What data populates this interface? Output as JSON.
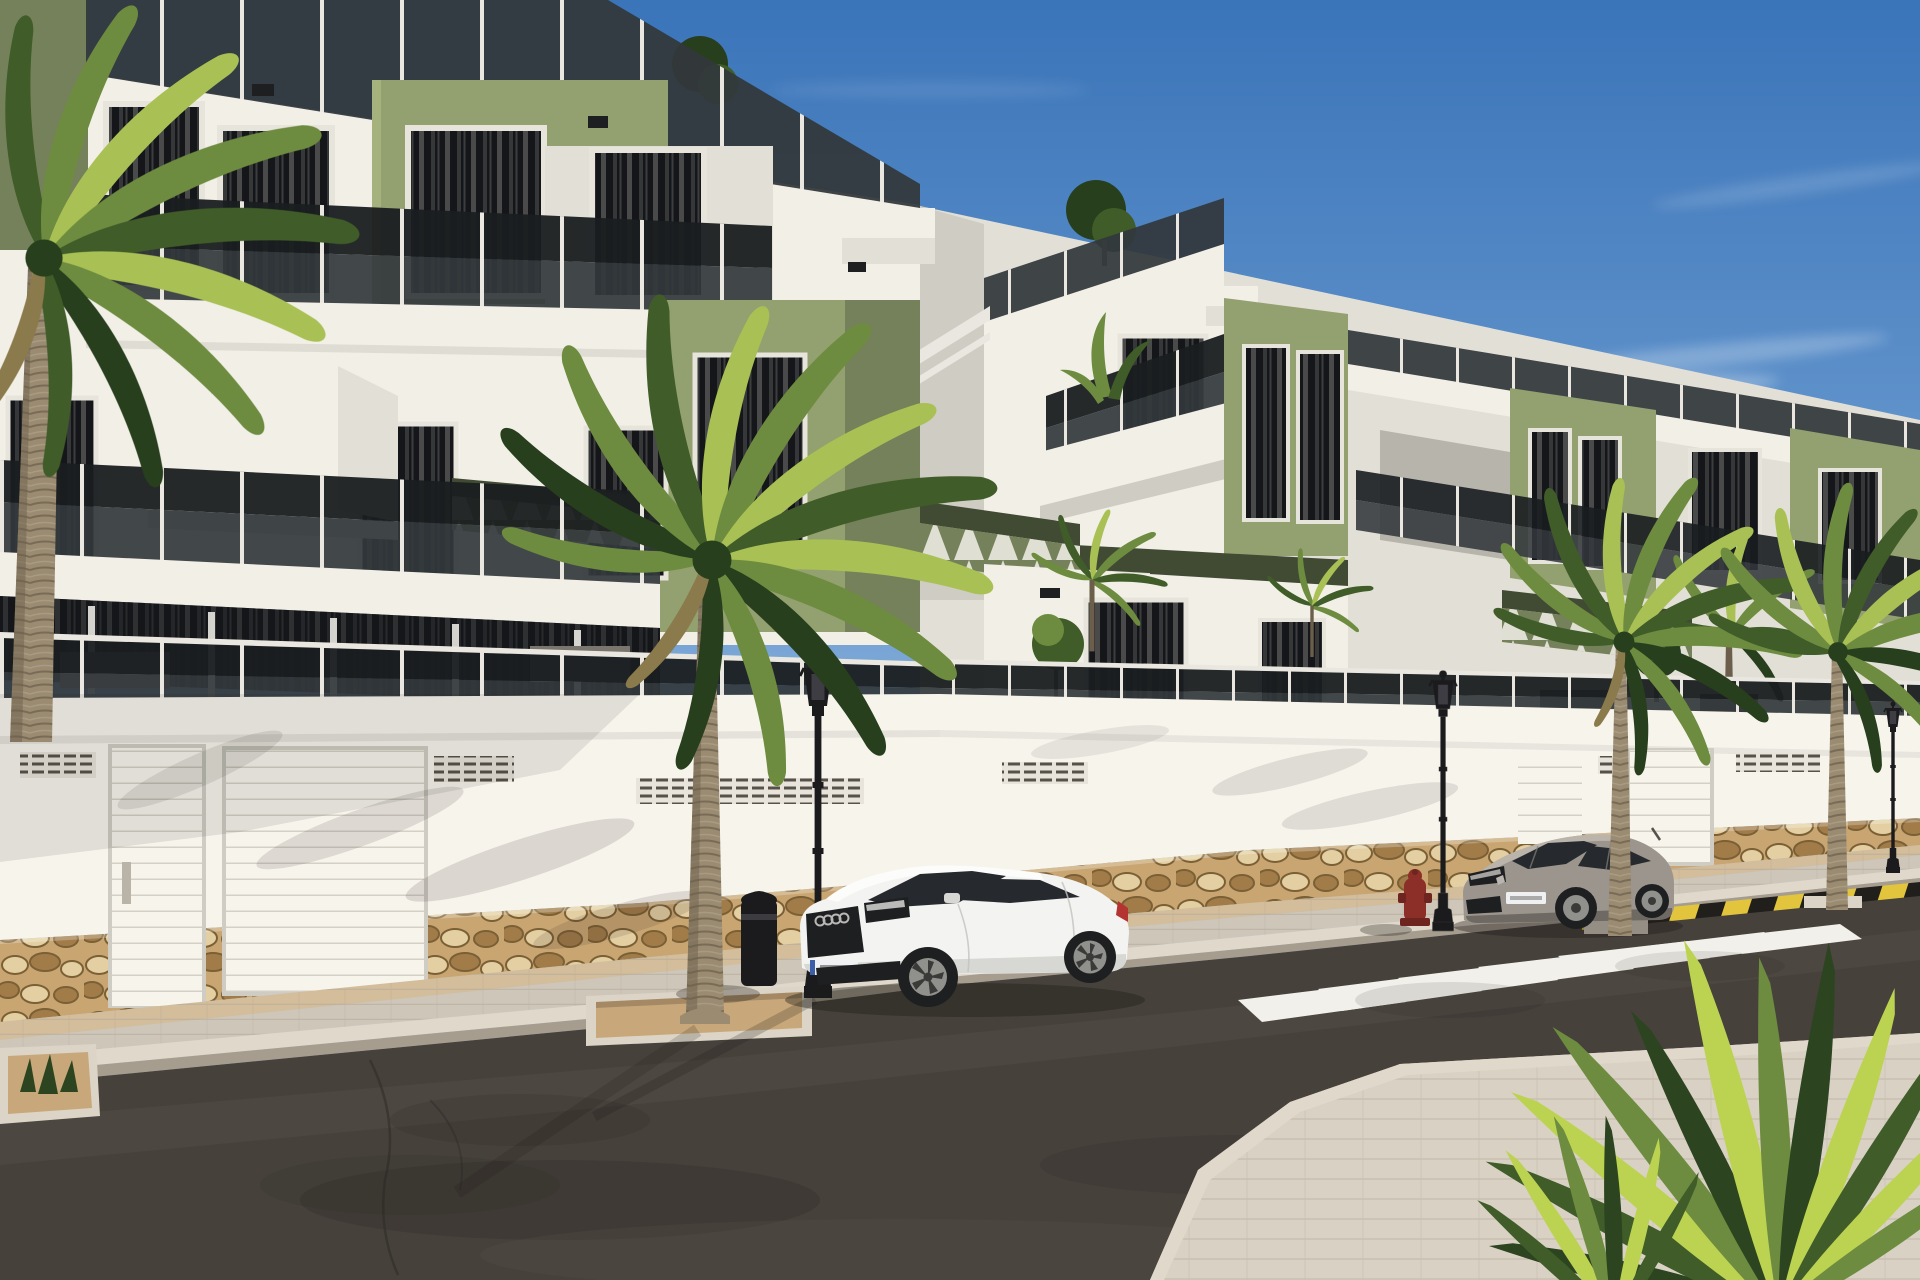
{
  "scene": {
    "type": "architectural-render",
    "description": "Sunny photorealistic render of a modern three-storey white apartment complex with olive-green accent volumes, smoked-glass balcony balustrades, green pergolas and rooftop terraces. A long white perimeter wall with sectional garage doors and a rubble-stone base lines a dark asphalt street with a zebra crosswalk, yellow-and-black curb hazard marking, ornate black street lamps, a litter bin and a red fire hydrant. A white sports coupe and a grey coupe are parked at the curb among tall palm trees; a bright spiky yucca fills the lower-right foreground under a clear blue sky with thin cirrus clouds.",
    "sun_direction": "high upper-right",
    "sky_condition": "clear with thin cirrus streaks"
  },
  "counts": {
    "apartment_blocks": 2,
    "street_lamps": 3,
    "parked_cars": 2,
    "garage_doors": 4,
    "crosswalk_stripes": 7,
    "street_palm_trees": 4,
    "terrace_palms": 3,
    "rooftop_trees": 3,
    "planters": 4
  },
  "objects": [
    {
      "name": "apartment-block-left",
      "note": "three storeys, green accent box, glass balconies, rooftop glass balustrade"
    },
    {
      "name": "apartment-block-right",
      "note": "stepped terraces receding right, green accent boxes, pergolas, rooftop trees"
    },
    {
      "name": "background-houses",
      "note": "white gable house and shaded slope behind right palms"
    },
    {
      "name": "perimeter-wall",
      "note": "white, vent grilles, cornice, rubble stone base"
    },
    {
      "name": "garage-doors",
      "note": "white ribbed sectional doors, two left and two right"
    },
    {
      "name": "street",
      "note": "dark asphalt with wear marks and cracks"
    },
    {
      "name": "crosswalk",
      "note": "white zebra stripes receding to the right"
    },
    {
      "name": "hazard-curb-marking",
      "note": "yellow and black stripes along right curb"
    },
    {
      "name": "sidewalk-far",
      "note": "beige pavers with white curb"
    },
    {
      "name": "sidewalk-near",
      "note": "light pavers, bottom right corner"
    },
    {
      "name": "white-coupe",
      "note": "white two-door sports coupe parked facing left, black grille, alloy wheels"
    },
    {
      "name": "grey-coupe",
      "note": "grey two-door coupe parked further right facing left"
    },
    {
      "name": "street-lamp",
      "note": "ornate black lantern posts, three along the curb"
    },
    {
      "name": "litter-bin",
      "note": "black cylindrical bin on sidewalk"
    },
    {
      "name": "fire-hydrant",
      "note": "dark red, near crosswalk"
    },
    {
      "name": "palm-trees",
      "note": "tall fan palms at left edge, centre and right"
    },
    {
      "name": "yucca-plant",
      "note": "bright spiky cluster, lower-right foreground"
    },
    {
      "name": "planters",
      "note": "gravel beds with concrete edging at palm bases and lower-left"
    }
  ],
  "colors": {
    "sky_top": "#3a74b9",
    "sky_mid": "#6d9dd1",
    "sky_low": "#a8c7e5",
    "sky_horizon": "#d8e6f3",
    "cloud": "#ffffff",
    "white_lit": "#f2efe7",
    "white_soft": "#e2dfd6",
    "white_shade": "#cfccc3",
    "white_deep": "#b7b4ac",
    "wall_bright": "#f7f4ec",
    "wall_cream": "#ece6da",
    "green_lit": "#93a06f",
    "green_mid": "#75815a",
    "green_shade": "#5a6645",
    "green_deep": "#414b34",
    "glass_dark": "#1a1d20",
    "glass_mid": "#33383c",
    "glass_light": "#4d5357",
    "post_white": "#e9e7e0",
    "window_dark": "#141619",
    "frame_white": "#e7e4dc",
    "curtain": "#8e8e8a",
    "stone_bg": "#c9a671",
    "stone_light": "#e3cfa2",
    "stone_dark": "#a17c49",
    "stone_joint": "#7b6036",
    "asphalt": "#46413b",
    "asphalt_light": "#56504a",
    "asphalt_dark": "#332f2b",
    "sidewalk": "#cec6b8",
    "sidewalk_near": "#d9d1c4",
    "paver_tan": "#d3bd9a",
    "curb": "#e0d8ca",
    "curb_face": "#a69d8e",
    "stripe_white": "#f2f0ea",
    "hazard_yellow": "#e2c53c",
    "hazard_black": "#211f1c",
    "gravel": "#c8a87a",
    "planter_edge": "#dcd5c7",
    "palm_trunk": "#9a8b71",
    "palm_trunk_dark": "#6b5f4c",
    "frond_bright": "#a8c054",
    "frond_mid": "#6d8c3f",
    "frond_dark": "#3f5c29",
    "frond_deep": "#273f1c",
    "frond_dry": "#8a7a4c",
    "yucca_bright": "#bcd352",
    "yucca_dark": "#2c441f",
    "lamp_black": "#1b1b1e",
    "lamp_glass": "#43434a",
    "hydrant_red": "#8c2f28",
    "car_white": "#f3f3f1",
    "car_white_shade": "#d7d7d4",
    "car_glass": "#26292d",
    "car_dark": "#1d1f21",
    "rim_silver": "#90908c",
    "rim_dark": "#3a3a38",
    "car_grey": "#9b958d",
    "car_grey_light": "#bab4ab",
    "car_grey_dark": "#6e6962",
    "plate_white": "#eef0f1",
    "bg_slope": "#77766e",
    "hedge": "#3d4a30",
    "bush": "#3a5026"
  }
}
